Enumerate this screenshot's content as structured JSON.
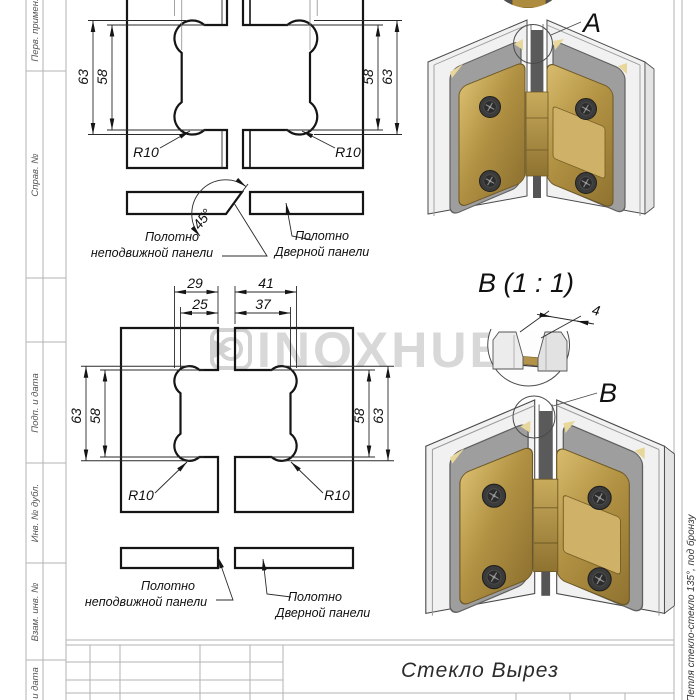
{
  "stamp_sidebar": {
    "labels": [
      "Перв. примен.",
      "Справ. №",
      "Подп. и дата",
      "Инв. № дубл.",
      "Взам. инв. №",
      "Подп. и дата"
    ]
  },
  "title_block": {
    "doc_title": "Стекло Вырез"
  },
  "right_margin": {
    "doc_name": "Петля стекло-стекло 135°, под бронзу"
  },
  "watermark": {
    "text": "INOXHUB"
  },
  "colors": {
    "brass": "#ad8c3f",
    "glass": "#f1f1f1",
    "line": "#151515",
    "watermark": "#d8d8d8"
  },
  "view_top": {
    "dims": {
      "height_outer_left": "63",
      "height_inner_left": "58",
      "height_inner_right": "58",
      "height_outer_right": "63",
      "radius_left": "R10",
      "radius_right": "R10",
      "bevel_angle": "45°"
    },
    "labels": {
      "fixed_line1": "Полотно",
      "fixed_line2": "неподвижной панели",
      "door_line1": "Полотно",
      "door_line2": "Дверной панели"
    }
  },
  "view_bottom": {
    "dims": {
      "width_outer_left": "29",
      "width_inner_left": "25",
      "width_outer_right": "41",
      "width_inner_right": "37",
      "height_outer_left": "63",
      "height_inner_left": "58",
      "height_inner_right": "58",
      "height_outer_right": "63",
      "radius_left": "R10",
      "radius_right": "R10"
    },
    "labels": {
      "fixed_line1": "Полотно",
      "fixed_line2": "неподвижной панели",
      "door_line1": "Полотно",
      "door_line2": "Дверной панели"
    }
  },
  "detail_a": {
    "label": "A"
  },
  "detail_b": {
    "label": "В",
    "title": "В (1 : 1)",
    "gap_dim": "4"
  }
}
